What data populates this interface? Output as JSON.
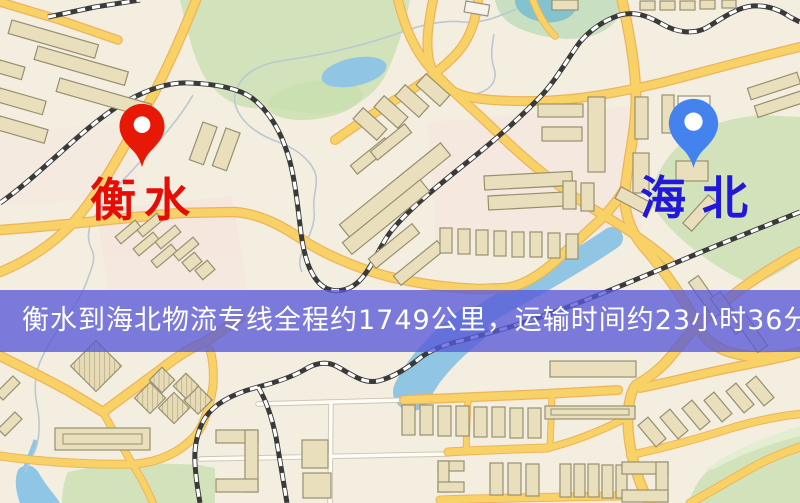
{
  "markers": {
    "origin": {
      "name": "衡水",
      "pin": "red"
    },
    "destination": {
      "name": "海北",
      "pin": "blue"
    }
  },
  "banner": {
    "text": "衡水到海北物流专线全程约1749公里，运输时间约23小时36分钟."
  },
  "css_vars": {
    "--map-bg": "#f4eee0",
    "--banner-bg": "rgba(89,90,217,0.78)",
    "--banner-text": "#ffffff",
    "--origin-pin": "#e81806",
    "--origin-label": "#e60d04",
    "--dest-pin": "#4482ee",
    "--dest-label": "#2317db",
    "--road-fill": "#f8d267",
    "--road-casing": "#edb45c",
    "--building-fill": "#eadfbc",
    "--building-stroke": "#97906f",
    "--green": "#d2e3bc",
    "--water": "#90c5e3",
    "--rail-dark": "#3a3a3a"
  }
}
